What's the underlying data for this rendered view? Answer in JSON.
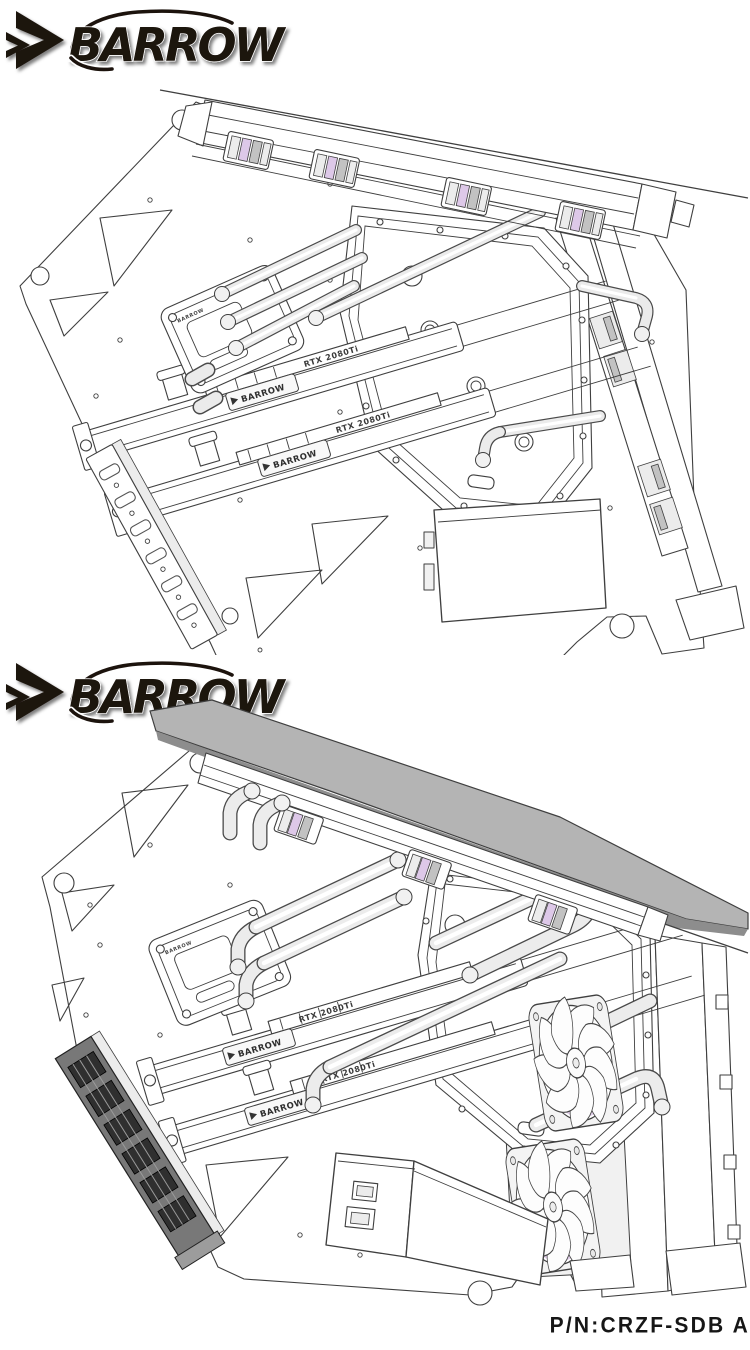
{
  "brand": {
    "name": "BARROW",
    "logo_icon": "double-chevron-right",
    "ink_color": "#1c130d"
  },
  "part_label": {
    "part_number": "P/N:CRZF-SDB A"
  },
  "drawing_top": {
    "cpu_block_label": "BARROW",
    "gpu_blocks": [
      {
        "brand": "BARROW",
        "model": "RTX 2080Ti"
      },
      {
        "brand": "BARROW",
        "model": "RTX 2080Ti"
      }
    ]
  },
  "drawing_bottom": {
    "cpu_block_label": "BARROW",
    "gpu_blocks": [
      {
        "brand": "BARROW",
        "model": "RTX 2080Ti"
      },
      {
        "brand": "BARROW",
        "model": "RTX 2080Ti"
      }
    ]
  },
  "colors": {
    "line": "#3f3f3f",
    "accent_lilac": "#ddc8e8",
    "panel_gray": "#b4b4b4",
    "logo_ink": "#1c130d",
    "background": "#ffffff"
  }
}
